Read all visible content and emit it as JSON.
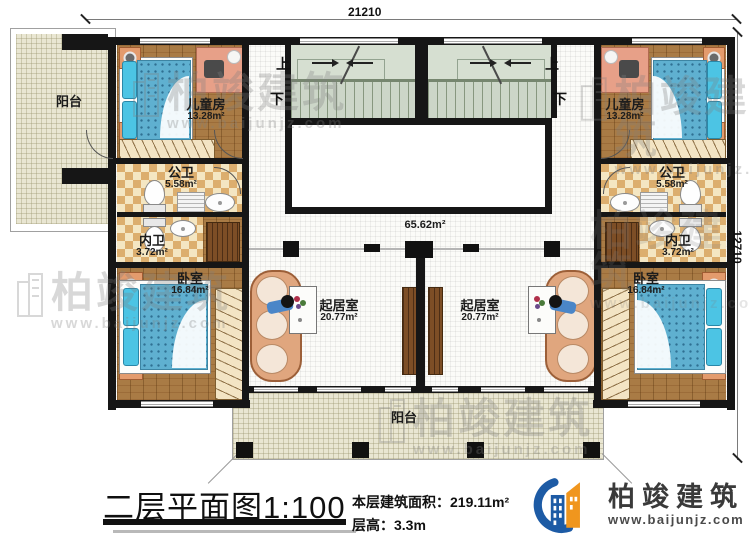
{
  "dimensions": {
    "top": "21210",
    "right": "12710"
  },
  "stairs": {
    "up": "上",
    "down": "下"
  },
  "hall_area": "65.62m²",
  "rooms": {
    "balcony_top": "阳台",
    "balcony_bottom": "阳台",
    "children_left": {
      "name": "儿童房",
      "area": "13.28m²"
    },
    "children_right": {
      "name": "儿童房",
      "area": "13.28m²"
    },
    "public_bath_left": {
      "name": "公卫",
      "area": "5.58m²"
    },
    "public_bath_right": {
      "name": "公卫",
      "area": "5.58m²"
    },
    "inner_bath_left": {
      "name": "内卫",
      "area": "3.72m²"
    },
    "inner_bath_right": {
      "name": "内卫",
      "area": "3.72m²"
    },
    "bedroom_left": {
      "name": "卧室",
      "area": "16.84m²"
    },
    "bedroom_right": {
      "name": "卧室",
      "area": "16.84m²"
    },
    "living_left": {
      "name": "起居室",
      "area": "20.77m²"
    },
    "living_right": {
      "name": "起居室",
      "area": "20.77m²"
    }
  },
  "title_block": {
    "title": "二层平面图1:100",
    "floor_area_label": "本层建筑面积：",
    "floor_area_value": "219.11m²",
    "floor_height": "层高：3.3m"
  },
  "logo": {
    "name": "柏竣建筑",
    "url": "www.baijunjz.com"
  },
  "watermark": {
    "text": "柏竣建筑",
    "url": "www.baijunjz.com"
  },
  "colors": {
    "wall": "#161616",
    "wood": "#a97b45",
    "stair": "#ccd6c8",
    "mattress": "#5fb0d0",
    "logo_blue": "#1d5ba5",
    "logo_orange": "#f0961e"
  }
}
